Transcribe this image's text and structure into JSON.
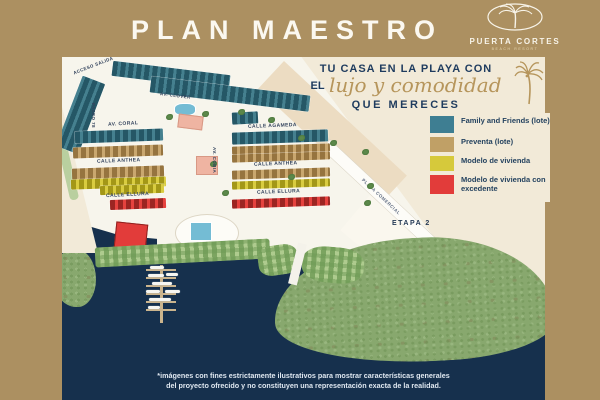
{
  "header": {
    "title": "PLAN MAESTRO",
    "logo": {
      "name": "PUERTA CORTES",
      "tagline": "BEACH RESORT"
    }
  },
  "hero": {
    "line1": "TU CASA EN LA PLAYA CON",
    "line2_prefix": "EL",
    "line2_script": "lujo y comodidad",
    "line3": "QUE MERECES"
  },
  "legend": {
    "items": [
      {
        "label": "Family and Friends (lote)",
        "color": "#3e7e92"
      },
      {
        "label": "Preventa (lote)",
        "color": "#c0a066"
      },
      {
        "label": "Modelo de vivienda",
        "color": "#d6c93b"
      },
      {
        "label": "Modelo de vivienda con excedente",
        "color": "#e23c3a"
      }
    ]
  },
  "map": {
    "labels": {
      "acceso_salida": "ACCESO SALIDA",
      "av_clover": "AV. CLOVER",
      "av_coral": "AV. CORAL",
      "paseo": "PASEO 78",
      "av_cobia": "AV. COBIA",
      "calle_agameda": "CALLE AGAMEDA",
      "calle_anthea_left": "CALLE ANTHEA",
      "calle_anthea_right": "CALLE ANTHEA",
      "calle_ellura_left": "CALLE ELLURA",
      "calle_ellura_right": "CALLE ELLURA",
      "plaza_comercial": "PLAZA COMERCIAL",
      "etapa": "ETAPA 2"
    }
  },
  "footer": {
    "disclaimer_line1": "*imágenes con fines estrictamente ilustrativos para mostrar características generales",
    "disclaimer_line2": "del proyecto ofrecido y no constituyen una representación exacta de la realidad."
  },
  "colors": {
    "background_tan": "#ac9061",
    "panel_cream": "#f2ead8",
    "water_navy": "#16304d",
    "accent_gold": "#b6955b",
    "text_navy": "#1e3b5e"
  }
}
